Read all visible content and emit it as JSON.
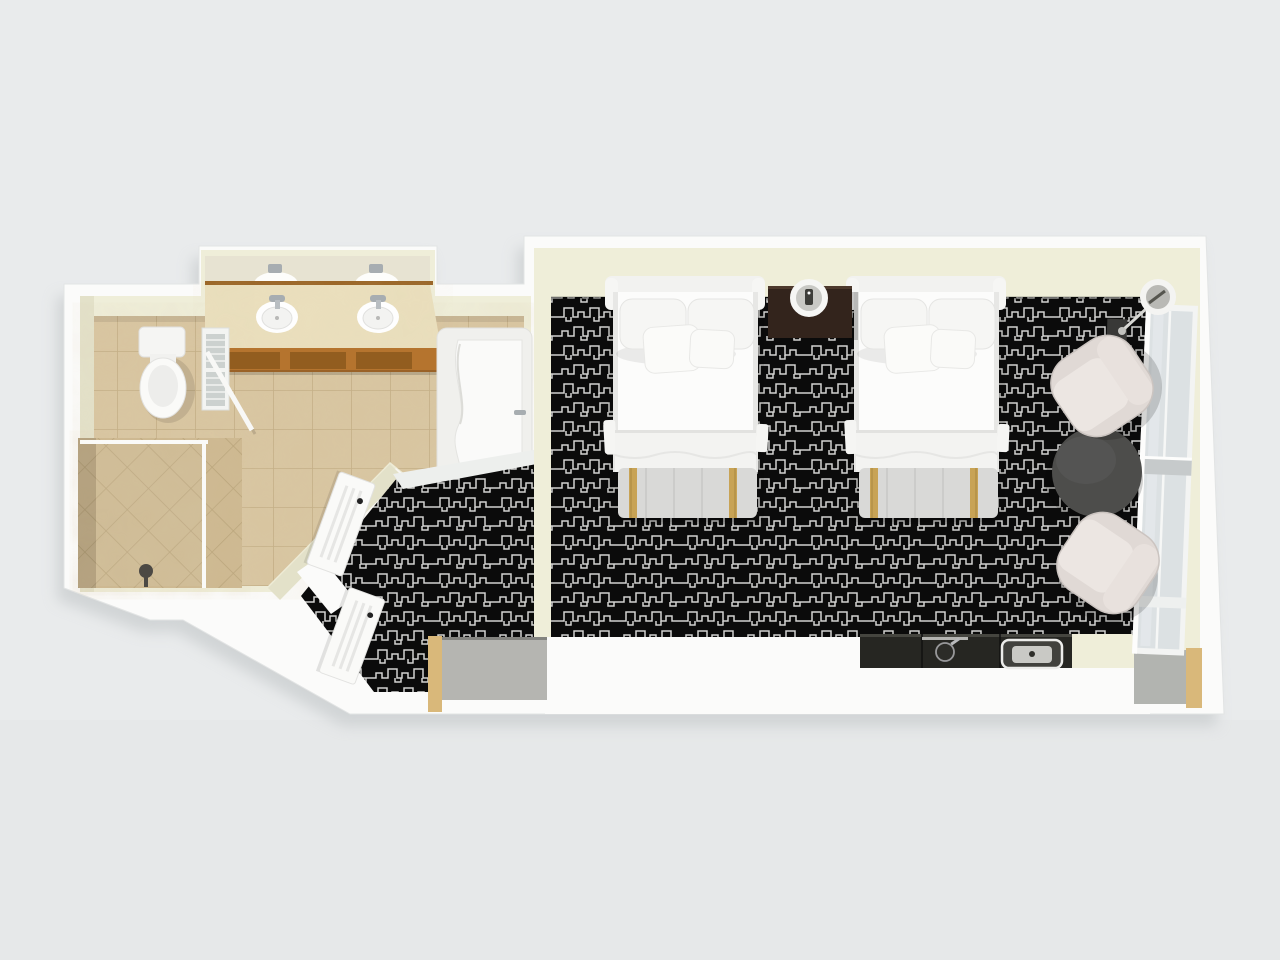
{
  "scene": {
    "kind": "3d-floorplan-render",
    "view": "top-down",
    "rooms": [
      {
        "name": "bathroom",
        "fixtures": [
          "toilet",
          "double-vanity",
          "vanity-sink-left",
          "vanity-sink-right",
          "vanity-mirror",
          "walk-in-shower",
          "shower-head",
          "bathtub",
          "louver-panel",
          "glass-partition"
        ]
      },
      {
        "name": "entry-hall",
        "fixtures": [
          "bathroom-door",
          "entry-door",
          "closet"
        ]
      },
      {
        "name": "bedroom",
        "fixtures": [
          "bed-1",
          "bed-2",
          "nightstand",
          "table-lamp",
          "luggage-bench-1",
          "luggage-bench-2",
          "armchair-1",
          "armchair-2",
          "round-table",
          "floor-lamp",
          "kitchenette-counter",
          "counter-sink",
          "counter-appliance",
          "window-wall",
          "wall-unit"
        ]
      }
    ],
    "counts": {
      "beds": 2,
      "sinks_bathroom": 2,
      "armchairs": 2,
      "doors": 2,
      "pillows_per_bed": 4
    }
  },
  "palette": {
    "background": "#e9ebec",
    "shadow": "#b9bec0",
    "wall_outer": "#fbfbfa",
    "wall_outer_edge": "#e2e4e4",
    "wall_inner": "#efeed9",
    "wall_inner_dark": "#e3e1c9",
    "tile": "#d8c5a0",
    "tile_grout": "#c2ad84",
    "tile_shower": "#cdb890",
    "carpet": "#0b0b0b",
    "carpet_line": "#d2d2d0",
    "linen": "#fcfcfb",
    "headboard": "#f2f2f0",
    "bench": "#d9d9d7",
    "gold": "#c8a355",
    "nightstand": "#33241c",
    "vanity_wood": "#b5742e",
    "vanity_top": "#eadfbd",
    "chair": "#e0d9d5",
    "chair_seat": "#ece6e2",
    "table": "#4d4d4b",
    "counter": "#262622",
    "glass": "#dce1e3",
    "closet": "#b5b5b1",
    "alcove_wood": "#d9b87a",
    "door": "#fafaf8",
    "chrome": "#a7adb1",
    "threshold": "#edefed"
  }
}
